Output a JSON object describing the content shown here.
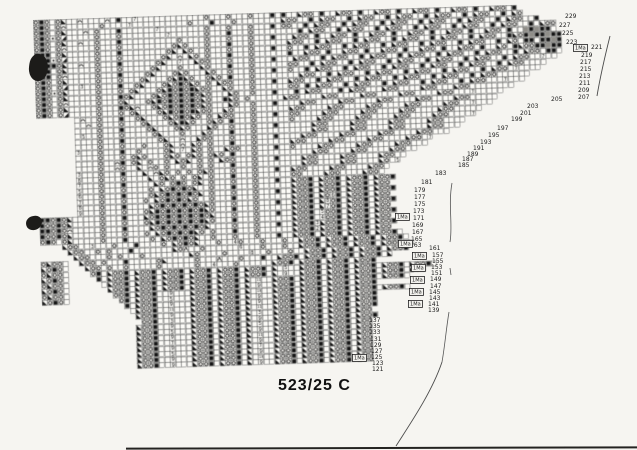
{
  "page": {
    "label": "523/25 C",
    "background": "#f6f5f1"
  },
  "chart": {
    "cell_size": 5.5,
    "rotation_deg": -1.8,
    "colors": {
      "grid_line": "#4f4f4f",
      "symbol": "#141414",
      "cell_bg": "#fcfbf7",
      "shade": "#8f8d88"
    },
    "symbol_legend": {
      "o": "circle-stitch",
      "#": "filled-square-stitch",
      "L": "left-triangle-decrease",
      "R": "right-triangle-decrease",
      "n": "arch-stitch",
      "*": "dot-stitch",
      "A": "lambda-stitch",
      "%": "shaded-cell",
      "E": "11",
      "T": "13"
    },
    "rows": [
      {
        "s": 0,
        "t": "o#o.oL..n....n.#..7............o...o...o...#.#..Loo.#..Loo.#..Loo.#..Loo.#..Loo.#..Loo.#"
      },
      {
        "s": 0,
        "t": "o#o.on......o....7..........o...#...o........Loo..#.Loo..#.Loo..#.Loo..#.Loo..#.Loo..#.Lo"
      },
      {
        "s": 0,
        "t": "o#o.oL...n.o...#......7........o...o...o...#.oo..#.Loo..#.Loo..#.Loo..#.Loo..#.Loo..#.Loo..#"
      },
      {
        "s": 0,
        "t": "o#o*oR.....o...o........7......o...#...o........#.Loo..#.Loo..#.Loo..#.Loo..#.Loo..#.Loo..#.Loo"
      },
      {
        "s": 0,
        "t": "o#o.oL..n..o...#..........o....o...o...o...#...Loo.#..Loo.#..Loo.#..Loo.#..Loo.#..Loo.#..%#%##."
      },
      {
        "s": 0,
        "t": "o#o.on.....o...o.........oLo...o...#...o......Loo..#.Loo..#.Loo..#.Loo..#.Loo..#.Loo..#Lo#%##%##"
      },
      {
        "s": 0,
        "t": "###.oL.....o...#........oL.Lo..o...o...o...#..o..#.Loo..#.Loo..#.Loo..#.Loo..#.Loo..#.Lo.##.##%#"
      },
      {
        "s": 0,
        "t": "###*oR.....o...o.......oL.n.Lo.o...#...o......#..Loo.#..Loo.#..Loo.#..Loo.#..Loo.#..Lo.#Loo##%##"
      },
      {
        "s": 0,
        "t": "####oL..n..o...#......oL..7..Loo...o...o...#...Loo..#.Loo..#.Loo..#.Loo..#.Loo..#.Loo..#.Loo.##."
      },
      {
        "s": 0,
        "t": "###.oL.....o...o.....oL...o...Lo...#...o......oo..#.Loo..#.Loo..#.Loo..#.Loo..#.Loo..#.Loo..7.."
      },
      {
        "s": 0,
        "t": "###.on.....o...#....oL...oLo...Lo..o...o...#..o..#.Loo..#.Loo..#.Loo..#.Loo..#.Loo..#.Loo...."
      },
      {
        "s": 0,
        "t": "o#o.oL.....o...o...oL...oL#Lo..oLo.#...o........Loo..#.Loo..#.Loo..#.Loo..#.Loo..#.Loo.7...."
      },
      {
        "s": 0,
        "t": "o#o.oR..3..o...#..oL...oLo#oLo.o.Loo...o...#..Loo..#.Loo..#.Loo..#.Loo..#.Loo..#.Loo......"
      },
      {
        "s": 0,
        "t": "o#o*oL.....o...o.oL...oL#o#o#Loo..Lo...o......oo.#.Loo..#.Loo..#.Loo..#.Loo..#.Loo...7..."
      },
      {
        "s": 0,
        "t": "o#o.oL.....o...#oL...oLo#o#o#oLo...Lo..o...#...#.Loo...#.Loo...Loo....Loo...Loo........"
      },
      {
        "s": 0,
        "t": "o#o.on.....o...oL...oL#o#o#o#oLo..#Lo.o......Loo....Loo....Loo....Loo....Loo...7....."
      },
      {
        "s": 0,
        "t": "o#o.oL.....o...#oLn..oLo#o#o#oLo...Lo..o...#....Loo....Loo....Loo....Loo....Loo....."
      },
      {
        "s": 0,
        "t": "o#o.oR.....o...o.oL...oL#o#o#Loo..Lo...o......Loo....Loo....Loo....Loo....Loo..7..."
      },
      {
        "s": 7,
        "t": ".n..o...#..oL...oLo#oLo.o.Loo...o...#..oo....Loo....Loo....Loo....Loo....."
      },
      {
        "s": 7,
        "t": "..n.o...o...oL...oL#Lo..oLo.#...o......o....Loo....Loo....Loo....Loo....7"
      },
      {
        "s": 7,
        "t": "....o...#....oL...oLo...Lo..o...o...#......Loo....Loo....Loo....Loo...."
      },
      {
        "s": 7,
        "t": ".5..o...o.....oL...o...Lo...#...o..........Loo....Loo....Loo....Loo..."
      },
      {
        "s": 7,
        "t": "....o...#......oL..n..Loo...o...o...#....Loo....Loo....Loo....Loo..."
      },
      {
        "s": 7,
        "t": "....o...o...o...oL.n.Lo.o...#...o......Loo....Loo....Loo....Loo.7"
      },
      {
        "s": 7,
        "t": "3...o...#..o....oL.7.Lo.o..Loo..o...#..o....Loo....Loo....Loo..."
      },
      {
        "s": 7,
        "t": "....o...o.oLo...oLo.oLo.oLo.#...o..........Loo....Loo....Loo.."
      },
      {
        "s": 7,
        "t": "....o..n#.oL.o..o.LoL.o.o.Loo...o...#....Loo....Loo....Loo.."
      },
      {
        "s": 7,
        "t": "....o..no..L.no.o..o..o.o...#...o........Loo....Loo....Lo.5"
      },
      {
        "s": 7,
        "t": "3...o...#...L.nLo.o.o.oLo...o...o...#..Loo....Loo....Loo."
      },
      {
        "s": 7,
        "t": "8...o...o....L.oLo.o.oL.o...#...o......oo....Loo....Loo."
      },
      {
        "s": 7,
        "t": "7...o...#.....Lo.o#o.oL.o...o...o...#..Loo#.Loo#.Loo#.Loo#"
      },
      {
        "s": 7,
        "t": "5...o...o....o.Lo#o#oL..o...#...o......Loo#.Loo#.Loo#.Loo"
      },
      {
        "s": 7,
        "t": "6...o...#....oLo#o#o#oL.o...o...o...#..Loo#.Loo#.Loo#.Loo#"
      },
      {
        "s": 7,
        "t": "7...o...o...o.Lo#o#oLo..o...#...o......Loo#.Lo6#.Loo#.Loo"
      },
      {
        "s": 7,
        "t": "8...o...#....Lo#o#o#o#oLo...o...o...#..Loo#.L8o#.Loo#.Loo#"
      },
      {
        "s": 7,
        "t": "9...o...o...oL#o#o#o#o#Lo...#...o......Loo#.L7o#.Loo#.Loo"
      },
      {
        "s": 0,
        "t": "##o#oL.....o...#...Lo#o#o#o#o#oL...o...o...#..Loo#.5oo#.Loo#.Loo#"
      },
      {
        "s": 0,
        "t": "#oo#oL.....o...o...oL#o#o#o#o#Lo...#...o......Loo#.4oo#.Loo#.Loo"
      },
      {
        "s": 0,
        "t": "##o#on.....o...#....Lo#o#o#o#oL....o...o...#..Loo#3Loo#.Loo#.Loo#"
      },
      {
        "s": 0,
        "t": "#oo#oL.....o...o...o.Lo#o#o#Lo.o...#...o......Loo#2Loo#.Loo#.Loo"
      },
      {
        "s": 0,
        "t": "o#o.oL.....o...#....o.Lo#o#oL..o...o...o...#..Loo#.Loo#.Loo#.Loo#."
      },
      {
        "s": 4,
        "t": "Loo..3...o...#....o.Lo#oL...o..4o...o...o..Loo#.Loo#.Loo#.Loo#."
      },
      {
        "s": 5,
        "t": "Loo..o.o...#.......LoA..o......6...o...o..Loo#.Loo#.Loo#.Loo#.L"
      },
      {
        "s": 6,
        "t": "Loo...o.o...o........Lo....o....8..o...o..Loo#.Loo#.Loo#.Loo#"
      },
      {
        "s": 0,
        "t": "oLoo.  Loo.o...#.....oL.....o...A...o...#..Loo#.Loo#.Loo#.Loo#.L"
      },
      {
        "s": 0,
        "t": "Lo#o.   Loo.o..o.....o......o..4...o......Loo#.Loo#.Loo#.Loo#"
      },
      {
        "s": 0,
        "t": "oLoo.    o#.Loo#.Loo#.Loo#.Loo#.Loo#.Loo#.L.5..Loo#.Loo#.Loo#.Loo#.Loo#."
      },
      {
        "s": 0,
        "t": "Lo#o.     #.Loo#.Loo#.Loo#.Loo#.Loo#.Loo#.L.9..Loo#.Loo#.Loo#.Loo#.Loo"
      },
      {
        "s": 0,
        "t": "oLoo.      .Loo#.Loo#.Loo#.Loo#.Loo#.L.E..Loo#.Loo#.Loo#.Loo#.Loo#."
      },
      {
        "s": 0,
        "t": "Lo#o.       Loo#.Loo#.Loo#.Loo#.Loo#.L.9..Loo#.Loo#.Loo#.Loo#"
      },
      {
        "s": 0,
        "t": "oLoo.        oo#.Loo#..9...Loo#.Loo#.L.T..Loo#.Loo#.Loo#.Loo#.Loo#."
      },
      {
        "s": 0,
        "t": "Lo#o.         o#.Loo#..5...Loo#.Loo#.L.9..Loo#.Loo#.Loo#.Loo#"
      },
      {
        "s": 15,
        "t": "#.Loo#..9...Loo#.Loo#.L.9..Loo#.Loo#.Loo#.Loo#"
      },
      {
        "s": 16,
        "t": ".Loo#..E...Loo#.Loo#.L.E..Loo#.Loo#.Loo#.Loo#"
      },
      {
        "s": 17,
        "t": "Loo#..9...Loo#.Loo#.L.3..Loo#.Loo#.Loo#.Loo"
      },
      {
        "s": 18,
        "t": "oo#..3...Loo#.Loo#.L.9..Loo#.Loo#.Loo#.Loo#"
      },
      {
        "s": 17,
        "t": "Loo#..9...Loo#.Loo#.L.5..Loo#.Loo#.Loo#.Loo"
      },
      {
        "s": 17,
        "t": "Loo#..5...Loo#.Loo#.L.9..Loo#.Loo#.Loo#.Loo"
      },
      {
        "s": 17,
        "t": "Loo#..9...Loo#.Loo#.L.E..Loo#.Loo#.Loo#.Loo"
      },
      {
        "s": 17,
        "t": "Loo#..7...Loo#.Loo#.L.9..Loo#.Loo#.Loo#.Loo"
      },
      {
        "s": 17,
        "t": "Loo#..9...Loo#.Loo#.L.7..Loo#.Loo#.Loo#.Loo"
      },
      {
        "s": 17,
        "t": "Loo#..5...Loo#.Loo#.L.9..Loo#.Loo#.Loo#.Loo"
      },
      {
        "s": 17,
        "t": "Loo#..9...Loo#.Loo#.L.T..Loo#.Loo#.Loo#.Loo"
      },
      {
        "s": 17,
        "t": "Loo#..9...Loo#.Loo#.L.9..Loo#.Loo#.Loo#.Loo"
      }
    ]
  },
  "annotations": {
    "ma_label": "1Ma",
    "row_numbers": [
      {
        "t": "229",
        "x": 565,
        "y": 14
      },
      {
        "t": "227",
        "x": 559,
        "y": 23
      },
      {
        "t": "225",
        "x": 562,
        "y": 31
      },
      {
        "t": "223",
        "x": 566,
        "y": 40
      },
      {
        "t": "221",
        "x": 591,
        "y": 45
      },
      {
        "t": "219",
        "x": 581,
        "y": 53
      },
      {
        "t": "217",
        "x": 580,
        "y": 60
      },
      {
        "t": "215",
        "x": 580,
        "y": 67
      },
      {
        "t": "213",
        "x": 579,
        "y": 74
      },
      {
        "t": "211",
        "x": 579,
        "y": 81
      },
      {
        "t": "209",
        "x": 578,
        "y": 88
      },
      {
        "t": "207",
        "x": 578,
        "y": 95
      },
      {
        "t": "205",
        "x": 551,
        "y": 97
      },
      {
        "t": "203",
        "x": 527,
        "y": 104
      },
      {
        "t": "201",
        "x": 520,
        "y": 111
      },
      {
        "t": "199",
        "x": 511,
        "y": 117
      },
      {
        "t": "197",
        "x": 497,
        "y": 126
      },
      {
        "t": "195",
        "x": 488,
        "y": 133
      },
      {
        "t": "193",
        "x": 480,
        "y": 140
      },
      {
        "t": "191",
        "x": 473,
        "y": 146
      },
      {
        "t": "189",
        "x": 467,
        "y": 152
      },
      {
        "t": "187",
        "x": 462,
        "y": 157
      },
      {
        "t": "185",
        "x": 458,
        "y": 163
      },
      {
        "t": "183",
        "x": 435,
        "y": 171
      },
      {
        "t": "181",
        "x": 421,
        "y": 180
      },
      {
        "t": "179",
        "x": 414,
        "y": 188
      },
      {
        "t": "177",
        "x": 414,
        "y": 195
      },
      {
        "t": "175",
        "x": 414,
        "y": 202
      },
      {
        "t": "173",
        "x": 413,
        "y": 209
      },
      {
        "t": "171",
        "x": 413,
        "y": 216
      },
      {
        "t": "169",
        "x": 412,
        "y": 223
      },
      {
        "t": "167",
        "x": 412,
        "y": 230
      },
      {
        "t": "165",
        "x": 411,
        "y": 237
      },
      {
        "t": "163",
        "x": 410,
        "y": 243
      },
      {
        "t": "161",
        "x": 429,
        "y": 246
      },
      {
        "t": "157",
        "x": 432,
        "y": 253
      },
      {
        "t": "155",
        "x": 432,
        "y": 259
      },
      {
        "t": "153",
        "x": 431,
        "y": 265
      },
      {
        "t": "151",
        "x": 431,
        "y": 271
      },
      {
        "t": "149",
        "x": 430,
        "y": 277
      },
      {
        "t": "147",
        "x": 430,
        "y": 284
      },
      {
        "t": "145",
        "x": 429,
        "y": 290
      },
      {
        "t": "143",
        "x": 429,
        "y": 296
      },
      {
        "t": "141",
        "x": 428,
        "y": 302
      },
      {
        "t": "139",
        "x": 428,
        "y": 308
      },
      {
        "t": "137",
        "x": 369,
        "y": 318
      },
      {
        "t": "135",
        "x": 369,
        "y": 324
      },
      {
        "t": "133",
        "x": 369,
        "y": 330
      },
      {
        "t": "131",
        "x": 370,
        "y": 337
      },
      {
        "t": "129",
        "x": 370,
        "y": 343
      },
      {
        "t": "127",
        "x": 371,
        "y": 349
      },
      {
        "t": "125",
        "x": 371,
        "y": 355
      },
      {
        "t": "123",
        "x": 372,
        "y": 361
      },
      {
        "t": "121",
        "x": 372,
        "y": 367
      }
    ],
    "ma_boxes": [
      {
        "x": 573,
        "y": 44
      },
      {
        "x": 395,
        "y": 213
      },
      {
        "x": 398,
        "y": 240
      },
      {
        "x": 412,
        "y": 252
      },
      {
        "x": 411,
        "y": 264
      },
      {
        "x": 410,
        "y": 276
      },
      {
        "x": 409,
        "y": 288
      },
      {
        "x": 408,
        "y": 300
      },
      {
        "x": 352,
        "y": 354
      }
    ]
  }
}
